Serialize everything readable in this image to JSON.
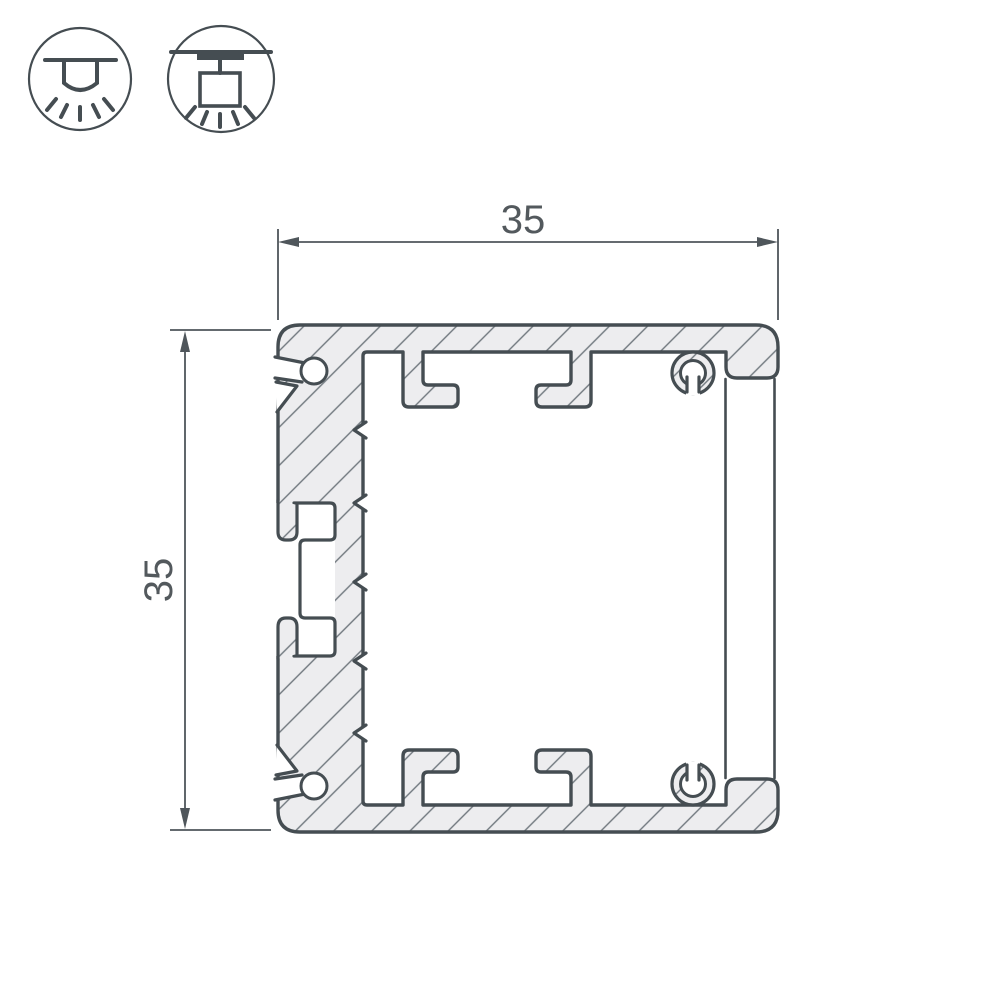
{
  "dimensions": {
    "width_label": "35",
    "height_label": "35"
  },
  "icons": [
    {
      "name": "recessed-mount-icon"
    },
    {
      "name": "surface-mount-icon"
    }
  ],
  "drawing": {
    "kind": "aluminum-profile-cross-section",
    "features": [
      "hatched-body",
      "keyhole-screw-slots",
      "t-slot-side-recess",
      "led-strip-hooks",
      "screw-bosses",
      "flat-diffuser-screen"
    ]
  },
  "colors": {
    "outline": "#454d52",
    "hatch_fill": "#ededef",
    "hatch_line": "#6f777d",
    "dimension": "#4f565b",
    "text": "#53595d",
    "background": "#ffffff"
  }
}
